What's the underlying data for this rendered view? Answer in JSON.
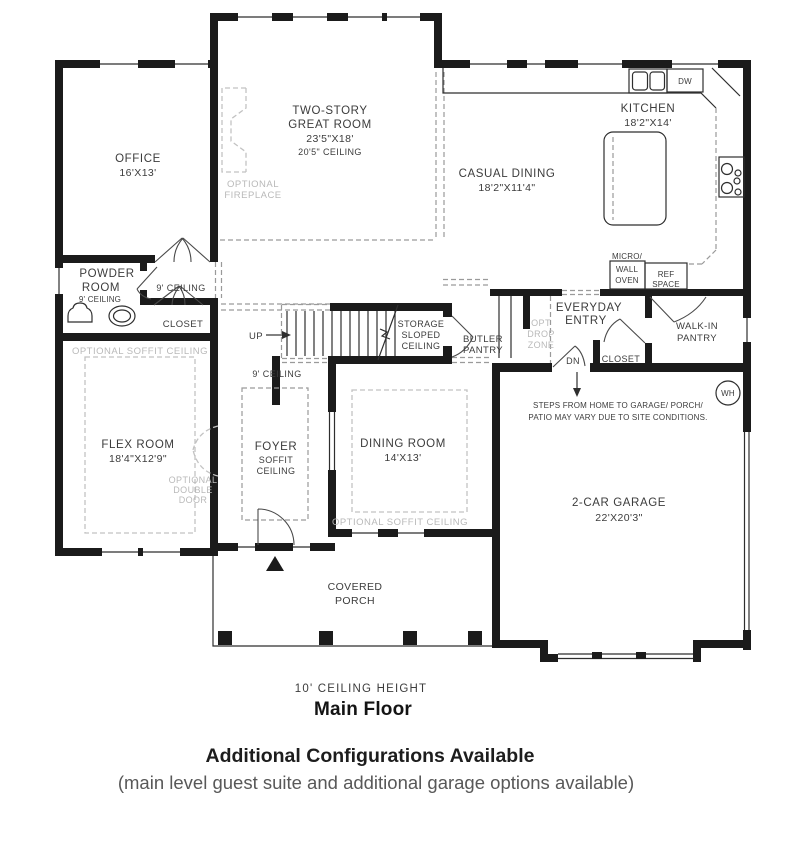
{
  "colors": {
    "wall": "#1b1b1b",
    "thin_line": "#2e2e2e",
    "dashed_line": "#9a9a9a",
    "optional_dashed": "#c2c2c2",
    "label_text": "#3c3c3c",
    "optional_text": "#b9b9b9"
  },
  "labels": {
    "office_name": "OFFICE",
    "office_dims": "16'X13'",
    "great_1": "TWO-STORY",
    "great_2": "GREAT ROOM",
    "great_dims": "23'5\"X18'",
    "great_ceiling": "20'5\" CEILING",
    "fireplace_1": "OPTIONAL",
    "fireplace_2": "FIREPLACE",
    "kitchen_name": "KITCHEN",
    "kitchen_dims": "18'2\"X14'",
    "casual_name": "CASUAL DINING",
    "casual_dims": "18'2\"X11'4\"",
    "dw": "DW",
    "micro": "MICRO/",
    "wall_txt": "WALL",
    "oven": "OVEN",
    "ref": "REF",
    "space": "SPACE",
    "powder_1": "POWDER",
    "powder_2": "ROOM",
    "powder_ceiling": "9' CEILING",
    "corridor_ceiling": "9' CEILING",
    "closet_1": "CLOSET",
    "flex_soffit": "OPTIONAL SOFFIT CEILING",
    "flex_name": "FLEX ROOM",
    "flex_dims": "18'4\"X12'9\"",
    "odd_1": "OPTIONAL",
    "odd_2": "DOUBLE",
    "odd_3": "DOOR",
    "up": "UP",
    "storage_1": "STORAGE",
    "storage_2": "SLOPED",
    "storage_3": "CEILING",
    "butler_1": "BUTLER",
    "butler_2": "PANTRY",
    "hall_ceiling": "9' CEILING",
    "foyer_1": "FOYER",
    "foyer_2": "SOFFIT",
    "foyer_3": "CEILING",
    "dining_name": "DINING ROOM",
    "dining_dims": "14'X13'",
    "dining_soffit": "OPTIONAL SOFFIT CEILING",
    "everyday_1": "EVERYDAY",
    "everyday_2": "ENTRY",
    "drop_1": "OPT",
    "drop_2": "DROP",
    "drop_3": "ZONE",
    "dn": "DN",
    "closet_2": "CLOSET",
    "walkin_1": "WALK-IN",
    "walkin_2": "PANTRY",
    "wh": "WH",
    "steps_1": "STEPS FROM HOME TO GARAGE/ PORCH/",
    "steps_2": "PATIO MAY VARY DUE TO SITE CONDITIONS.",
    "garage_name": "2-CAR GARAGE",
    "garage_dims": "22'X20'3\"",
    "porch_1": "COVERED",
    "porch_2": "PORCH"
  },
  "footer": {
    "ceiling_height": "10' CEILING HEIGHT",
    "floor_name": "Main Floor",
    "config_title": "Additional Configurations Available",
    "config_sub": "(main level guest suite and additional garage options available)"
  }
}
